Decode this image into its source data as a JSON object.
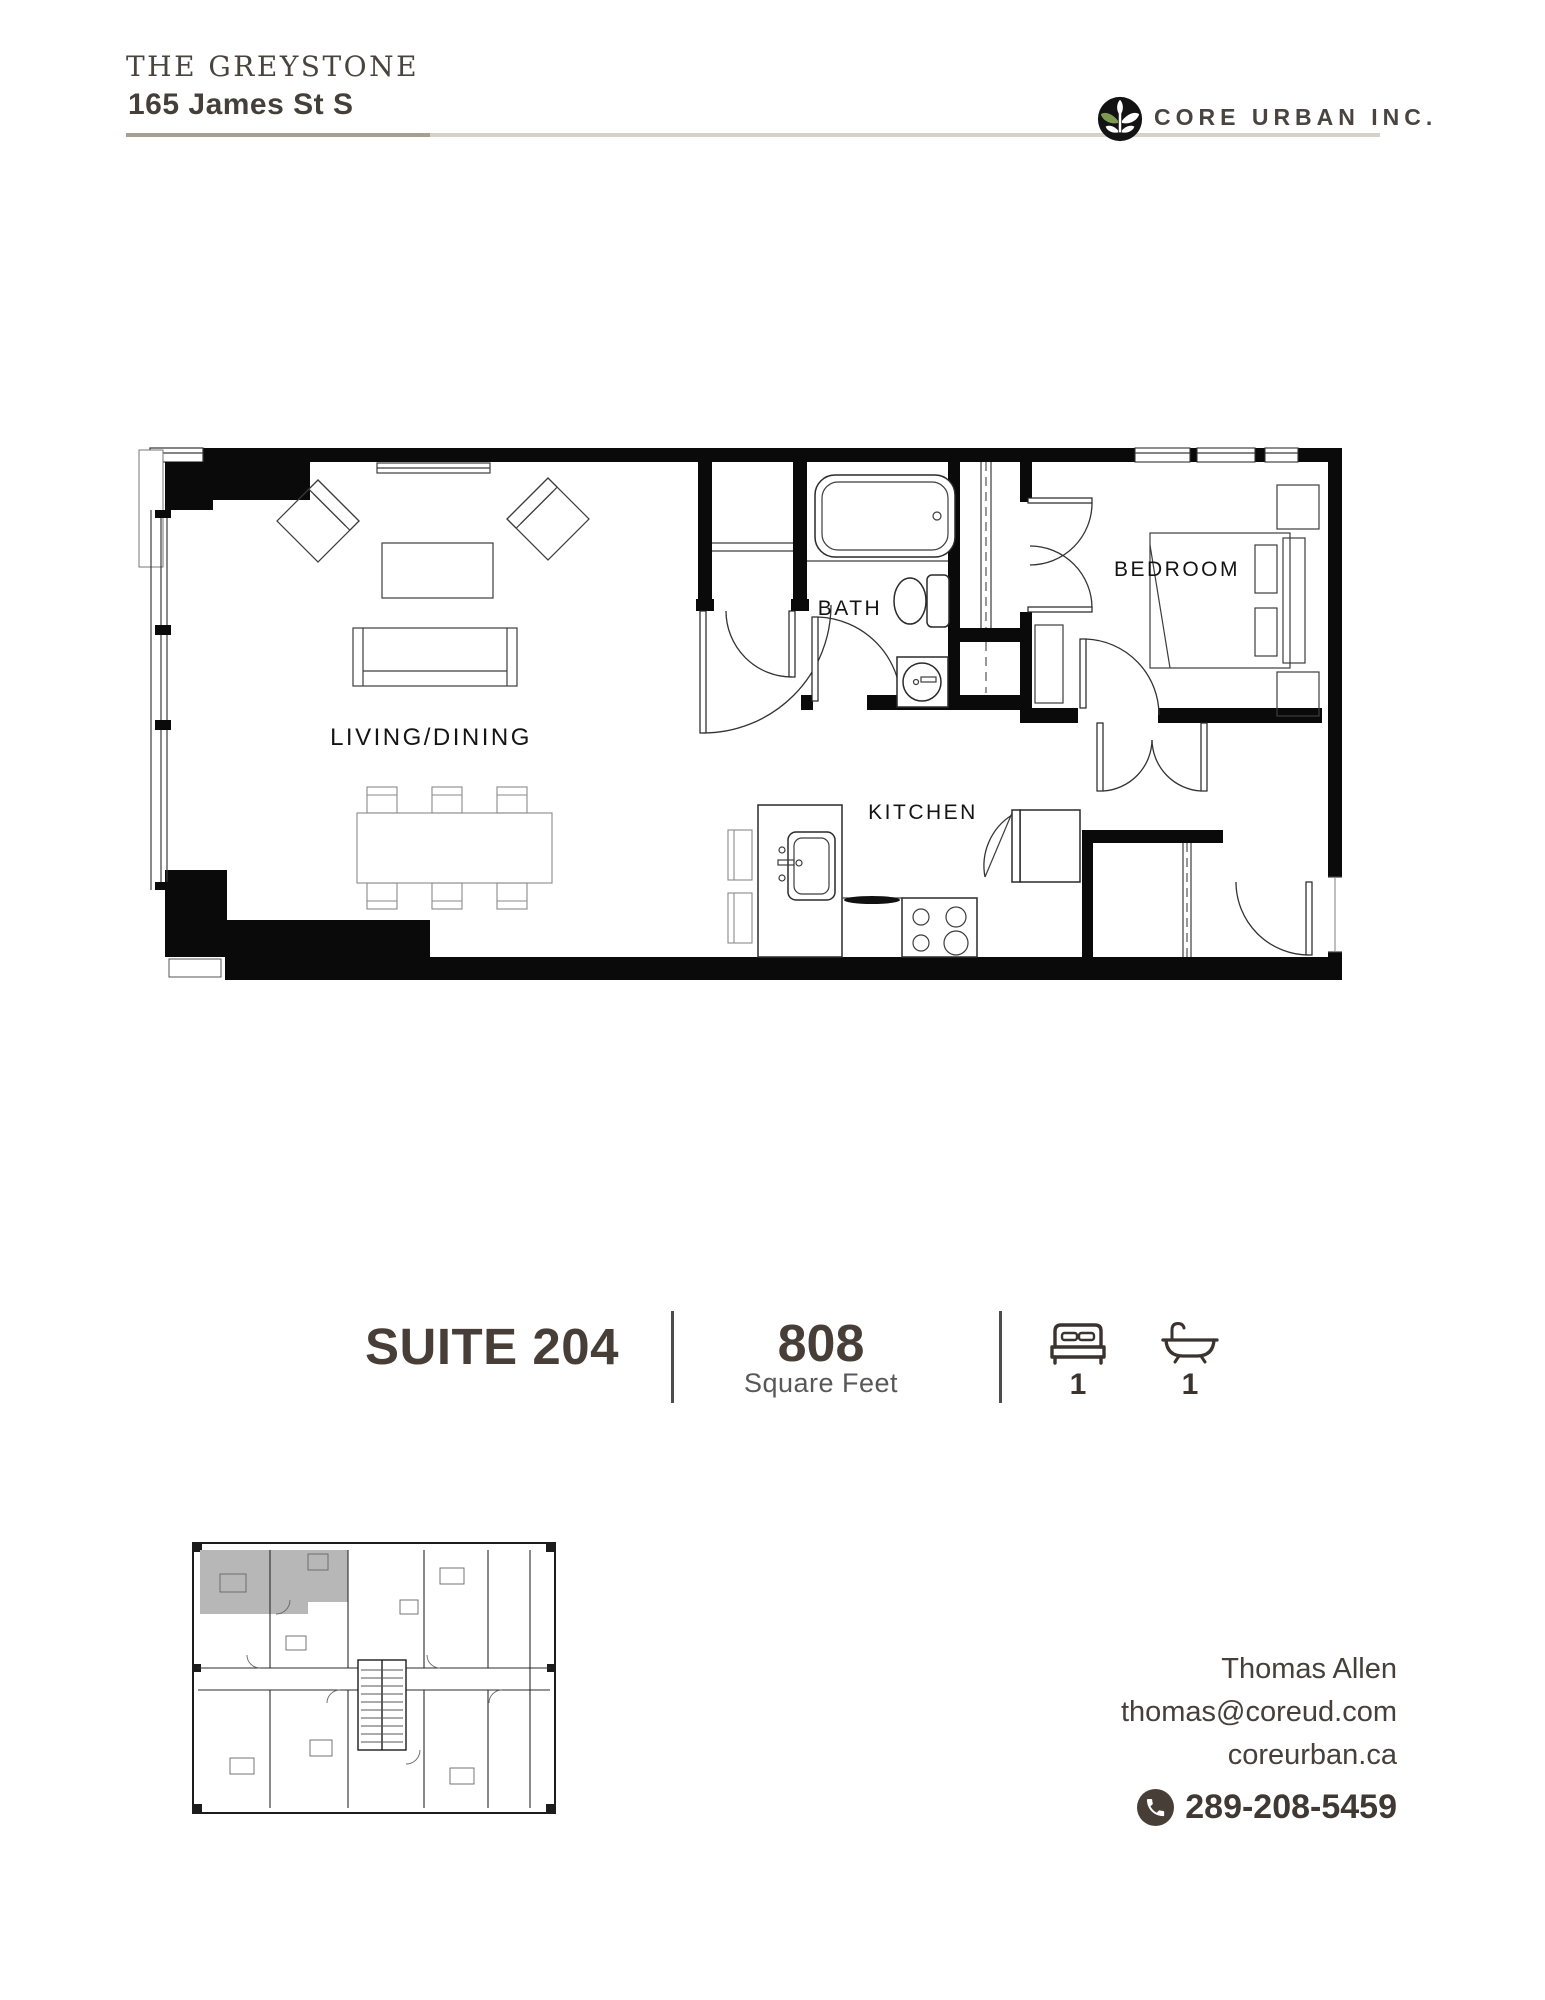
{
  "header": {
    "building_name": "THE GREYSTONE",
    "address": "165 James St S",
    "company": "CORE URBAN INC."
  },
  "plan": {
    "living_label": "LIVING/DINING",
    "bath_label": "BATH",
    "bedroom_label": "BEDROOM",
    "kitchen_label": "KITCHEN"
  },
  "suite": {
    "title": "SUITE 204",
    "area_value": "808",
    "area_label": "Square Feet",
    "bed_count": "1",
    "bath_count": "1"
  },
  "contact": {
    "name": "Thomas Allen",
    "email": "thomas@coreud.com",
    "website": "coreurban.ca",
    "phone": "289-208-5459"
  },
  "colors": {
    "text_dark": "#463f39",
    "suite_text": "#473e38",
    "accent_green": "#7d9c52",
    "rule_dark": "#a89f90",
    "rule_light": "#d7d2c8",
    "wall_black": "#0a0a0a",
    "keyplan_highlight": "#b7b7b7"
  }
}
